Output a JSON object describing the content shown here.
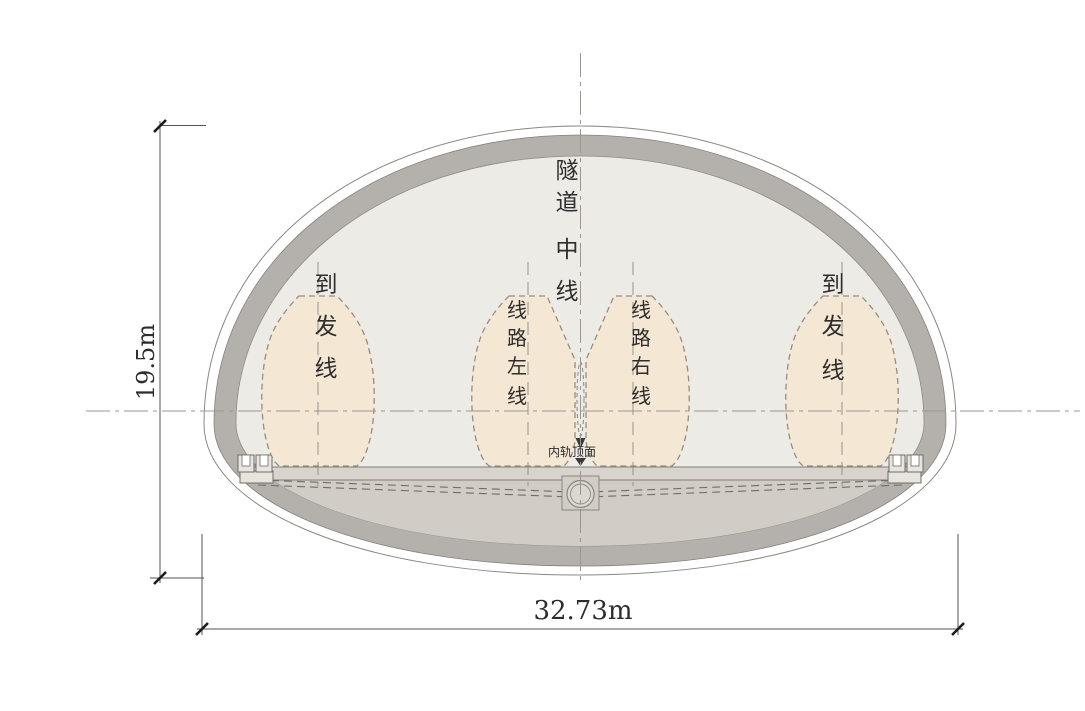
{
  "diagram": {
    "type": "railway-tunnel-cross-section",
    "dimensions": {
      "height": "19.5m",
      "width": "32.73m"
    },
    "labels": {
      "tunnel_centerline": [
        "隧",
        "道",
        "中",
        "线"
      ],
      "arrival_departure_left": [
        "到",
        "发",
        "线"
      ],
      "arrival_departure_right": [
        "到",
        "发",
        "线"
      ],
      "main_line_left": [
        "线",
        "路",
        "左",
        "线"
      ],
      "main_line_right": [
        "线",
        "路",
        "右",
        "线"
      ],
      "rail_top_surface": "内轨顶面"
    },
    "colors": {
      "lining-gray": "#b4b1ac",
      "interior": "#edebe6",
      "ballast": "#d1ccc5",
      "track-band": "#d8d4cd",
      "blob-fill": "#f4e7d4",
      "text": "#2e2d2b"
    }
  }
}
